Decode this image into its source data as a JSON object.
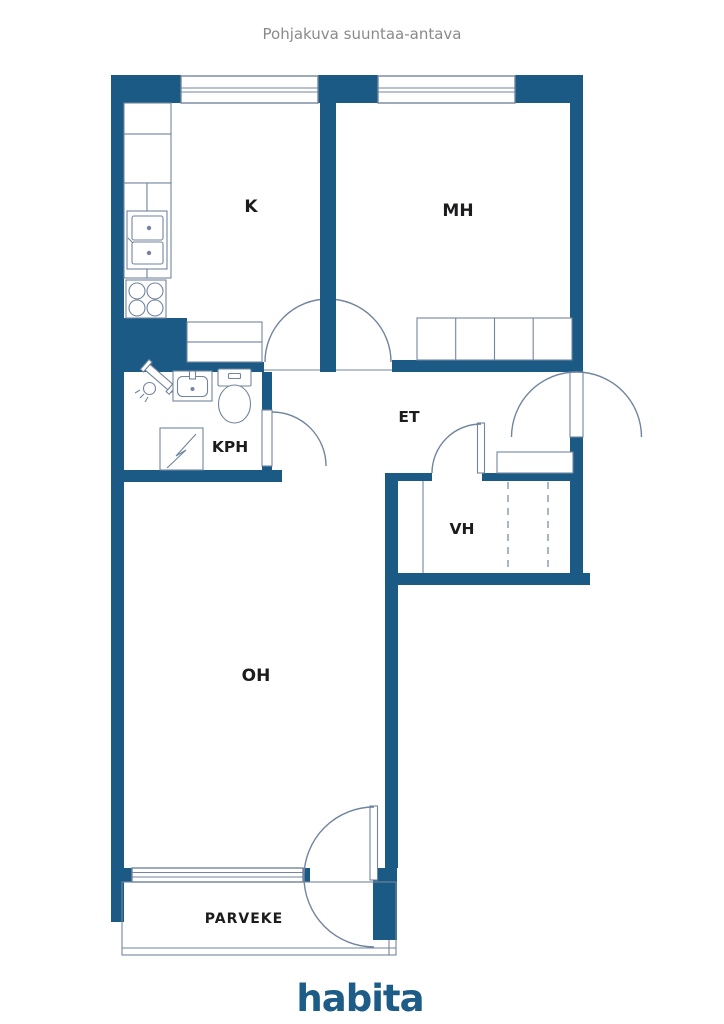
{
  "title": "Pohjakuva suuntaa-antava",
  "rooms": {
    "kitchen": {
      "label": "K"
    },
    "bedroom": {
      "label": "MH"
    },
    "hall": {
      "label": "ET"
    },
    "bathroom": {
      "label": "KPH"
    },
    "closet": {
      "label": "VH"
    },
    "living": {
      "label": "OH"
    },
    "balcony": {
      "label": "PARVEKE"
    }
  },
  "branding": {
    "logo": "habita"
  },
  "colors": {
    "wall": "#1b5a85",
    "fixture_line": "#72859e",
    "room_label": "#1c1c1e",
    "title_text": "#8a8a8a",
    "logo": "#1d5c87",
    "background": "#ffffff"
  }
}
